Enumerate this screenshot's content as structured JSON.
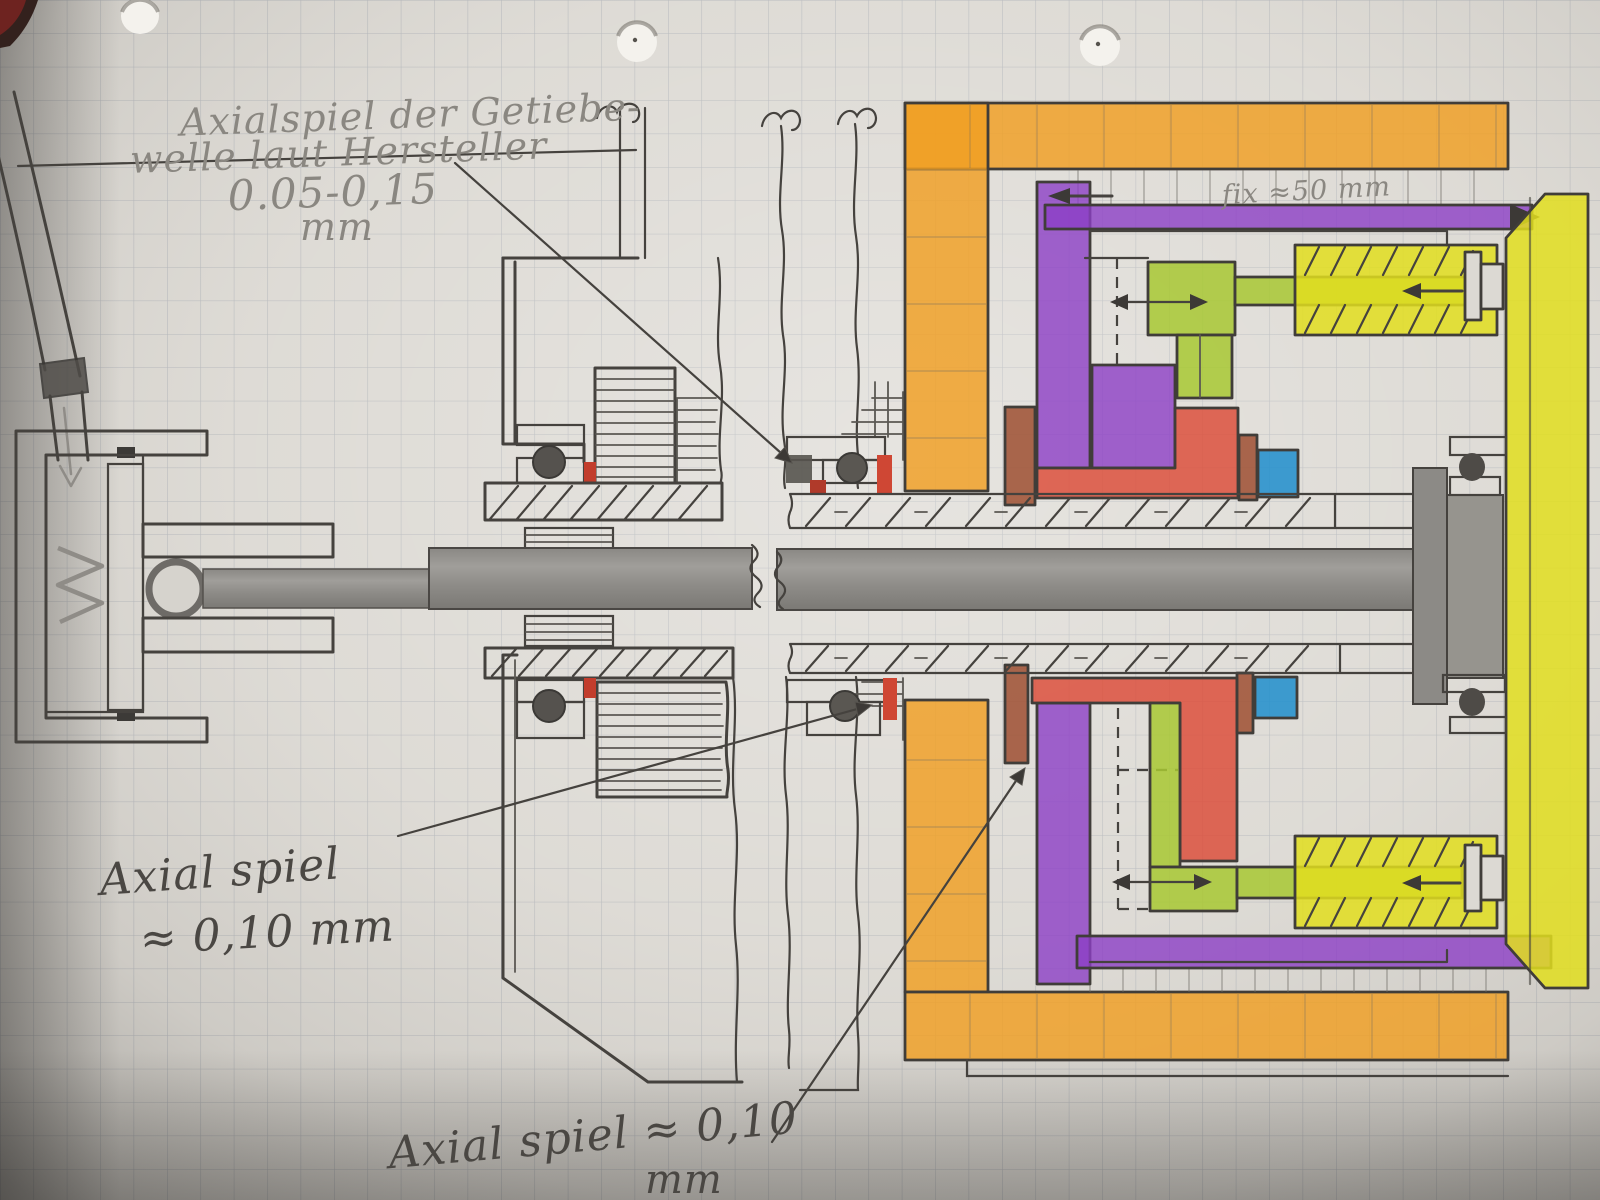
{
  "drawing": {
    "kind": "hand-drawn pencil sketch on squared paper",
    "subject": "Gearbox / clutch shaft cross-section with axial play annotations"
  },
  "annotations": {
    "gearbox_axial_play": {
      "line1": "Axialspiel der Getiebe-",
      "line2": "welle laut Hersteller",
      "line3": "0.05-0,15",
      "line4": "mm"
    },
    "axial_play_left": {
      "line1": "Axial spiel",
      "line2": "≈ 0,10 mm"
    },
    "axial_play_bottom": {
      "line1": "Axial spiel ≈ 0,10",
      "line2": "mm"
    },
    "fix_dimension": {
      "label": "fix ≈50 mm"
    }
  },
  "colors": {
    "orange": "#f09f22",
    "purple": "#8c3fc6",
    "green": "#a8c832",
    "yellow": "#e2de1f",
    "red": "#dc4a37",
    "blue": "#1f8ecd",
    "brown": "#9d4f31",
    "pencil": "#45423e",
    "shaft_gray": "#8e8c88",
    "paper": "#dcd9d3"
  }
}
